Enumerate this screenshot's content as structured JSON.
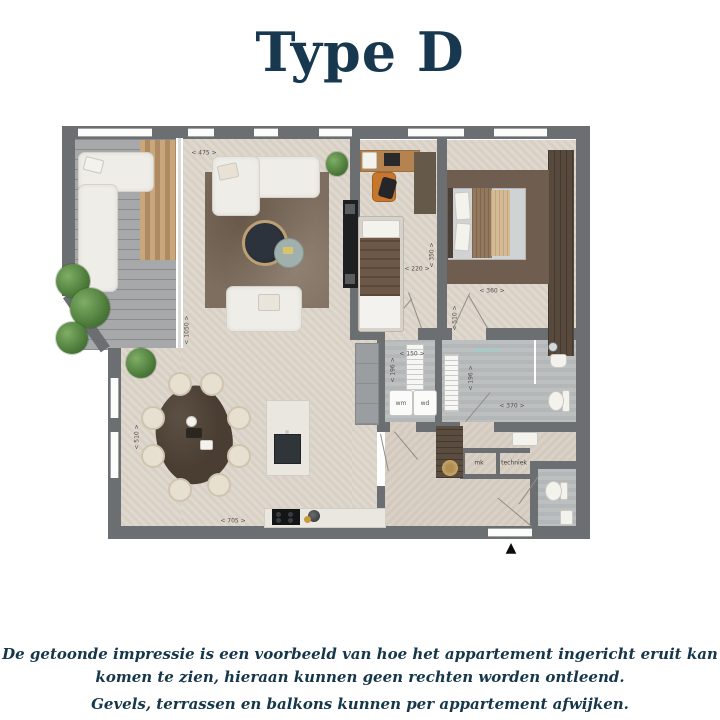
{
  "title": "Type D",
  "disclaimer": {
    "line1": "De getoonde impressie is een voorbeeld van hoe het appartement ingericht eruit kan",
    "line2": "komen te zien, hieraan kunnen geen rechten worden ontleend.",
    "line3": "Gevels, terrassen en balkons kunnen per appartement afwijken."
  },
  "floorplan": {
    "dimensions": {
      "living_width": "< 475 >",
      "living_length": "< 1050 >",
      "bedroom2_width": "< 220 >",
      "bedroom2_length": "< 350 >",
      "bedroom1_width": "< 360 >",
      "bedroom1_length": "< 510 >",
      "laundry_width": "< 150 >",
      "laundry_depth": "< 196 >",
      "bathroom_depth": "< 196 >",
      "bathroom_width": "< 370 >",
      "dining_depth": "< 510 >",
      "kitchen_width": "< 705 >"
    },
    "labels": {
      "shower": "douche",
      "washer": "wm",
      "dryer": "wd",
      "meter_cupboard": "mk",
      "technical": "techniek"
    },
    "entrance_marker": "▲",
    "colors": {
      "title_navy": "#17384e",
      "wall_gray": "#6b6f72",
      "floor_beige": "#ddd5ca",
      "tile_gray": "#b9bcbd",
      "deck_gray": "#a6a8aa",
      "rug_brown": "#7e6e5f",
      "wood_dark": "#57493b",
      "shower_label_teal": "#8fd4d4",
      "plant_green": "#4e7c3b"
    }
  }
}
